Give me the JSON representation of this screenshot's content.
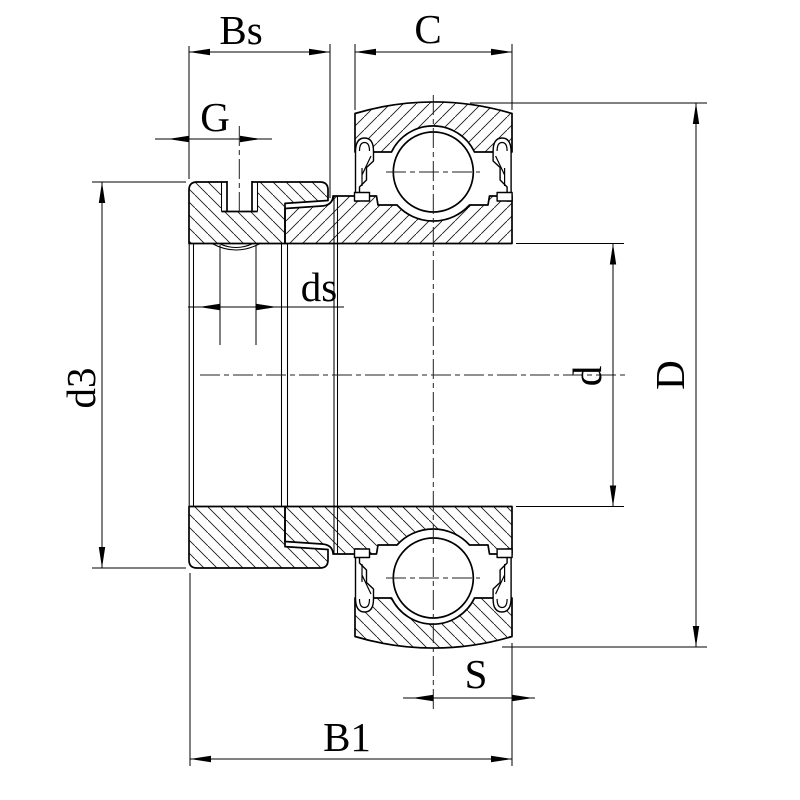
{
  "figure": {
    "description": "Dimensioned cross-section drawing of a radial insert ball bearing with eccentric locking collar",
    "background": "#ffffff",
    "line_color": "#000000"
  },
  "dimensions": {
    "bs": {
      "label": "Bs"
    },
    "c": {
      "label": "C"
    },
    "g": {
      "label": "G"
    },
    "ds": {
      "label": "ds"
    },
    "d3": {
      "label": "d3"
    },
    "d": {
      "label": "d"
    },
    "dd": {
      "label": "D"
    },
    "s": {
      "label": "S"
    },
    "b1": {
      "label": "B1"
    }
  }
}
